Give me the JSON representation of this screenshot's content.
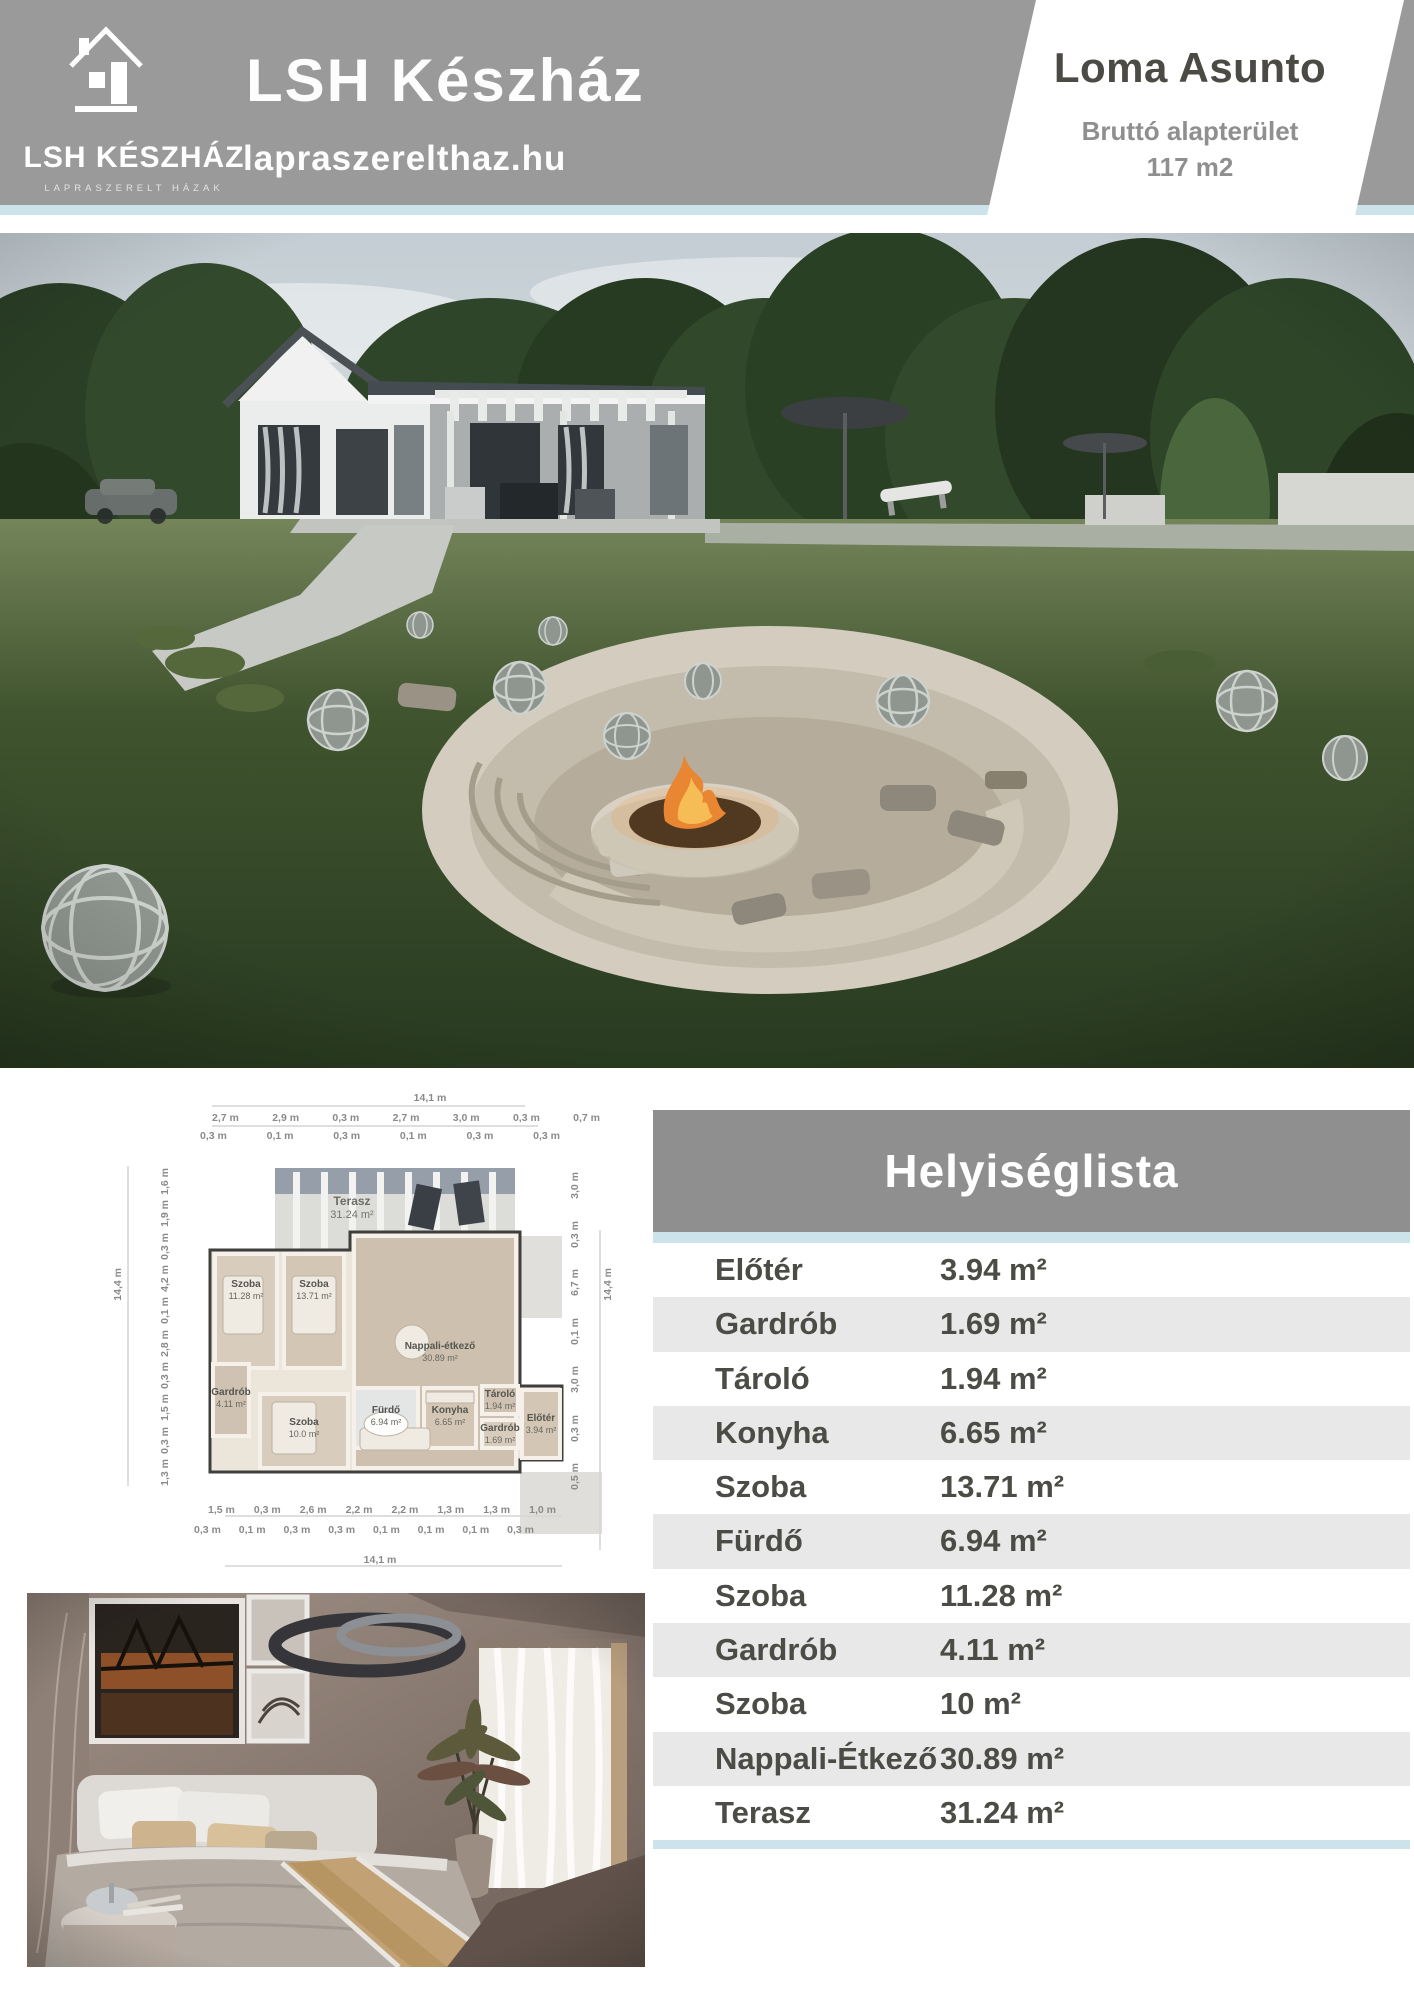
{
  "colors": {
    "header_gray": "#9a9a9a",
    "accent_blue": "#cde3eb",
    "table_header_gray": "#8f8f8f",
    "table_row_alt": "#e8e8e8",
    "text_dark": "#4b4a45",
    "text_muted": "#8f8f8f"
  },
  "header": {
    "logo_text": "LSH KÉSZHÁZ",
    "logo_tagline": "LAPRASZERELT HÁZAK",
    "title": "LSH Készház",
    "website": "lapraszerelthaz.hu",
    "banner_title": "Loma Asunto",
    "banner_label": "Bruttó alapterület",
    "banner_area": "117 m2"
  },
  "floorplan": {
    "total_width_top": "14,1 m",
    "total_width_bottom": "14,1 m",
    "total_height_left": "14,4 m",
    "total_height_right": "14,4 m",
    "dims_top_main": [
      "2,7 m",
      "2,9 m",
      "0,3 m",
      "2,7 m",
      "3,0 m",
      "0,3 m",
      "0,7 m"
    ],
    "dims_top_sub": [
      "0,3 m",
      "0,1 m",
      "0,3 m",
      "0,1 m",
      "0,3 m",
      "0,3 m"
    ],
    "dims_left": [
      "1,6 m",
      "1,9 m",
      "0,3 m",
      "4,2 m",
      "0,1 m",
      "2,8 m",
      "0,3 m",
      "1,5 m",
      "0,3 m",
      "1,3 m"
    ],
    "dims_right": [
      "3,0 m",
      "0,3 m",
      "6,7 m",
      "0,1 m",
      "3,0 m",
      "0,3 m",
      "0,5 m"
    ],
    "dims_bottom_main": [
      "1,5 m",
      "0,3 m",
      "2,6 m",
      "2,2 m",
      "2,2 m",
      "1,3 m",
      "1,3 m",
      "1,0 m"
    ],
    "dims_bottom_sub": [
      "0,3 m",
      "0,1 m",
      "0,3 m",
      "0,3 m",
      "0,1 m",
      "0,1 m",
      "0,1 m",
      "0,3 m"
    ],
    "rooms": [
      {
        "name": "Terasz",
        "area": "31.24 m²"
      },
      {
        "name": "Szoba",
        "area": "11.28 m²"
      },
      {
        "name": "Szoba",
        "area": "13.71 m²"
      },
      {
        "name": "Nappali-étkező",
        "area": "30.89 m²"
      },
      {
        "name": "Gardrób",
        "area": "4.11 m²"
      },
      {
        "name": "Szoba",
        "area": "10.0 m²"
      },
      {
        "name": "Fürdő",
        "area": "6.94 m²"
      },
      {
        "name": "Konyha",
        "area": "6.65 m²"
      },
      {
        "name": "Tároló",
        "area": "1.94 m²"
      },
      {
        "name": "Gardrób",
        "area": "1.69 m²"
      },
      {
        "name": "Előtér",
        "area": "3.94 m²"
      }
    ]
  },
  "room_table": {
    "title": "Helyiséglista",
    "rows": [
      {
        "name": "Előtér",
        "area": "3.94 m²"
      },
      {
        "name": "Gardrób",
        "area": "1.69 m²"
      },
      {
        "name": "Tároló",
        "area": "1.94 m²"
      },
      {
        "name": "Konyha",
        "area": "6.65 m²"
      },
      {
        "name": "Szoba",
        "area": "13.71 m²"
      },
      {
        "name": "Fürdő",
        "area": "6.94 m²"
      },
      {
        "name": "Szoba",
        "area": "11.28 m²"
      },
      {
        "name": "Gardrób",
        "area": "4.11 m²"
      },
      {
        "name": "Szoba",
        "area": "10 m²"
      },
      {
        "name": "Nappali-Étkező",
        "area": "30.89 m²"
      },
      {
        "name": "Terasz",
        "area": "31.24 m²"
      }
    ]
  }
}
